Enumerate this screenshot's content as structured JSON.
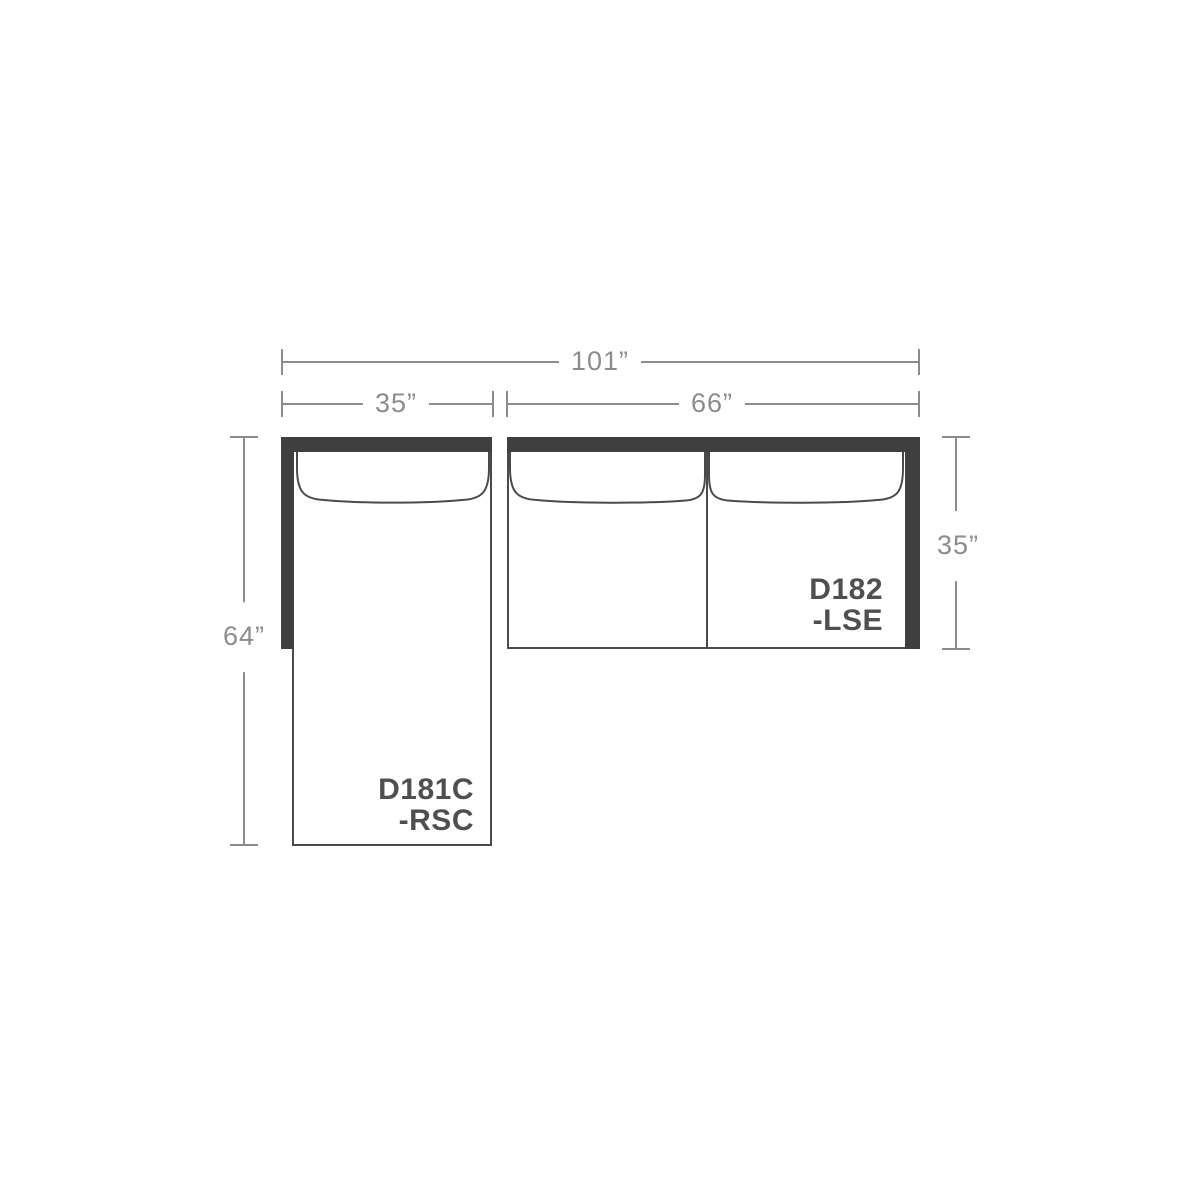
{
  "dimensions": {
    "overall_width": "101”",
    "chaise_width": "35”",
    "sofa_width": "66”",
    "chaise_depth": "64”",
    "sofa_depth": "35”"
  },
  "pieces": [
    {
      "model": "D181C",
      "suffix": "-RSC"
    },
    {
      "model": "D182",
      "suffix": "-LSE"
    }
  ],
  "colors": {
    "background": "#FFFFFF",
    "frame_dark": "#3F3F3F",
    "outline": "#4A4A4A",
    "dimension_gray": "#8C8C8C",
    "label_text": "#4F4F4F"
  }
}
